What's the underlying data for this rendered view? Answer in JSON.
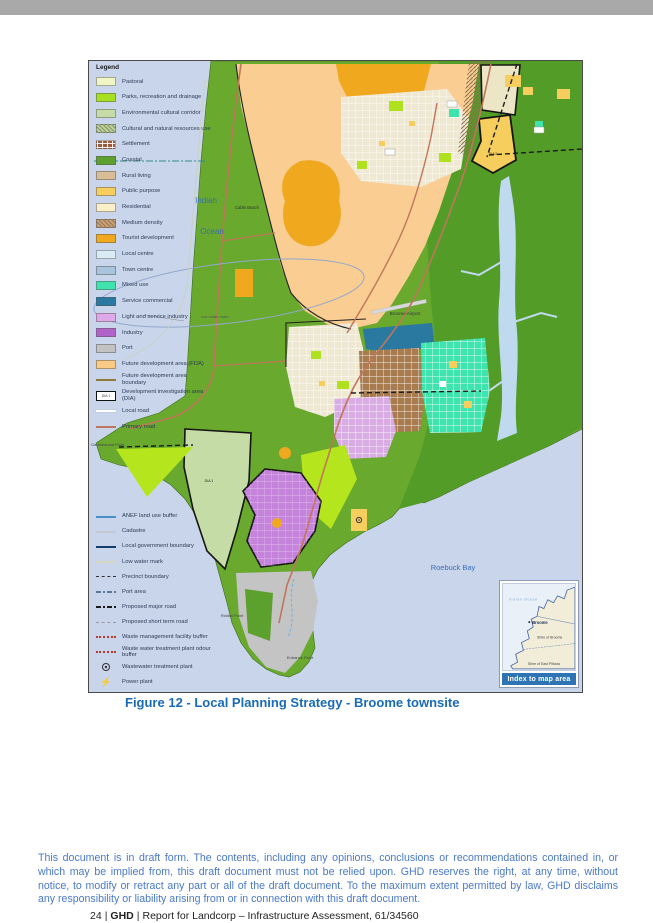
{
  "page": {
    "top_bar_color": "#A9A9A9",
    "caption": "Figure 12 - Local Planning Strategy - Broome townsite",
    "caption_color": "#1A6BB5",
    "footer": {
      "disclaimer": "This document is in draft form. The contents, including any opinions, conclusions or recommendations contained in, or which may be implied from, this draft document must not be relied upon. GHD reserves the right, at any time, without notice, to modify or retract any part or all of the draft document. To the maximum extent permitted by law, GHD disclaims any responsibility or liability arising from or in connection with this draft document.",
      "disclaimer_color": "#4A79C9",
      "page_number": "24",
      "separator": "|",
      "brand": "GHD",
      "report_ref": "Report for Landcorp – Infrastructure Assessment, 61/34560"
    }
  },
  "map": {
    "water_color": "#C9D5EB",
    "legend": {
      "title": "Legend",
      "zones": [
        {
          "label": "Pastoral",
          "type": "fill",
          "color": "#F0F5C4"
        },
        {
          "label": "Parks, recreation and drainage",
          "type": "fill",
          "color": "#A6E01E"
        },
        {
          "label": "Environmental cultural corridor",
          "type": "fill",
          "color": "#C6DCA6"
        },
        {
          "label": "Cultural and natural resources use",
          "type": "fill",
          "color": "#B9D09A",
          "pattern": "hatch"
        },
        {
          "label": "Settlement",
          "type": "fill",
          "color": "#9A5C3C",
          "pattern": "grid"
        },
        {
          "label": "Coastal",
          "type": "fill",
          "color": "#5CA02E"
        },
        {
          "label": "Rural living",
          "type": "fill",
          "color": "#D9BD97"
        },
        {
          "label": "Public purpose",
          "type": "fill",
          "color": "#F6CE5E"
        },
        {
          "label": "Residential",
          "type": "fill",
          "color": "#FAEFC9"
        },
        {
          "label": "Medium density",
          "type": "fill",
          "color": "#C9A277",
          "pattern": "hatch"
        },
        {
          "label": "Tourist development",
          "type": "fill",
          "color": "#F0A81F"
        },
        {
          "label": "Local centre",
          "type": "fill",
          "color": "#D9ECF6"
        },
        {
          "label": "Town centre",
          "type": "fill",
          "color": "#A9C5DD"
        },
        {
          "label": "Mixed use",
          "type": "fill",
          "color": "#3EE3AD"
        },
        {
          "label": "Service commercial",
          "type": "fill",
          "color": "#2979A1"
        },
        {
          "label": "Light and service industry",
          "type": "fill",
          "color": "#DFA9E9"
        },
        {
          "label": "Industry",
          "type": "fill",
          "color": "#B263C9"
        },
        {
          "label": "Port",
          "type": "fill",
          "color": "#C2C2C2"
        },
        {
          "label": "Future development area (FDA)",
          "type": "fill",
          "color": "#FBCB85"
        },
        {
          "label": "Future development area boundary",
          "type": "line",
          "color": "#8F7A3C"
        },
        {
          "label": "Development investigation area (DIA)",
          "type": "dia",
          "color": "#111111",
          "swatch_text": "DIA 1"
        },
        {
          "label": "Local road",
          "type": "line",
          "color": "#FFFFFF"
        },
        {
          "label": "Primary road",
          "type": "line",
          "color": "#C0765A"
        }
      ],
      "symbols": [
        {
          "label": "ANEF land use buffer",
          "type": "line",
          "color": "#4A90C8"
        },
        {
          "label": "Cadastre",
          "type": "line",
          "color": "#C3CAD6"
        },
        {
          "label": "Local government boundary",
          "type": "line",
          "color": "#123E6B"
        },
        {
          "label": "Low water mark",
          "type": "line",
          "color": "#D5D5C2"
        },
        {
          "label": "Precinct boundary",
          "type": "dash",
          "color": "#333333"
        },
        {
          "label": "Port area",
          "type": "dashdot",
          "color": "#5A7A9A"
        },
        {
          "label": "Proposed major road",
          "type": "dashdot",
          "color": "#1A1A1A"
        },
        {
          "label": "Proposed short term road",
          "type": "dash",
          "color": "#9A9A9A"
        },
        {
          "label": "Waste management facility buffer",
          "type": "dot",
          "color": "#C0392B"
        },
        {
          "label": "Waste water treatment plant odour buffer",
          "type": "dot",
          "color": "#C0392B"
        },
        {
          "label": "Wastewater treatment plant",
          "type": "circle",
          "color": "#333333"
        },
        {
          "label": "Power plant",
          "type": "bolt",
          "color": "#111111"
        }
      ]
    },
    "labels": {
      "ocean_line1": "Indian",
      "ocean_line2": "Ocean",
      "cable_beach": "Cable Beach",
      "low_water_mark": "low water mark",
      "airport": "Broome Airport",
      "roebuck_bay": "Roebuck Bay",
      "gantheaume_point": "Gantheaume Point",
      "riddell_point": "Riddell Point",
      "entrance_point": "Entrance Point",
      "dia5": "DIA 5",
      "dia1": "DIA 1"
    },
    "inset": {
      "title": "Index to map area",
      "title_bg": "#2E74B5",
      "ocean": "Indian Ocean",
      "town": "Broome",
      "shire1": "Shire of Broome",
      "shire2": "Shire of East Pilbara"
    }
  }
}
